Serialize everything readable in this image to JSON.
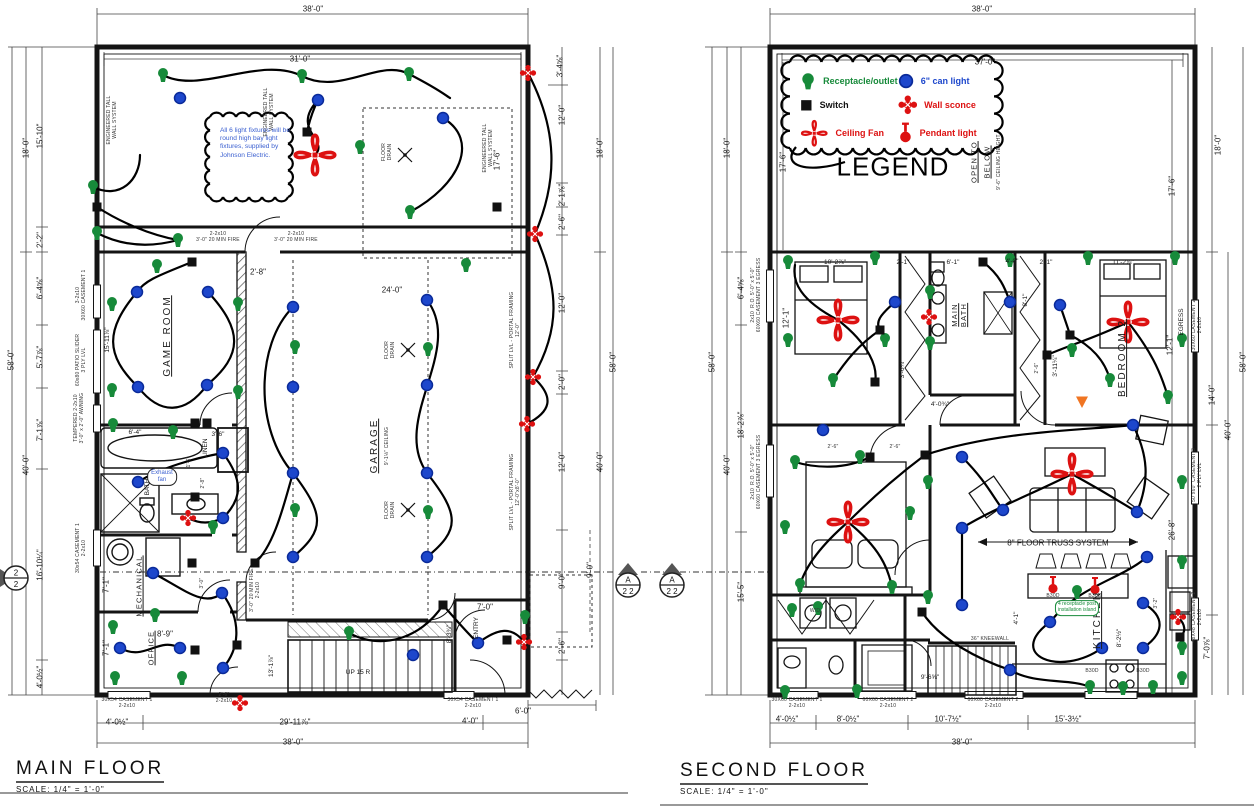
{
  "titles": {
    "main_floor": {
      "label": "MAIN FLOOR",
      "scale": "SCALE: 1/4\" = 1'-0\""
    },
    "second_floor": {
      "label": "SECOND FLOOR",
      "scale": "SCALE: 1/4\" = 1'-0\""
    }
  },
  "legend": {
    "title": "LEGEND",
    "items": [
      {
        "symbol": "r",
        "label": "Receptacle/outlet",
        "color": "#178a3a"
      },
      {
        "symbol": "c",
        "label": "6\" can light",
        "color": "#1d47cc"
      },
      {
        "symbol": "s",
        "label": "Switch",
        "color": "#111111"
      },
      {
        "symbol": "w",
        "label": "Wall sconce",
        "color": "#dd1111"
      },
      {
        "symbol": "f",
        "label": "Ceiling Fan",
        "color": "#dd1111"
      },
      {
        "symbol": "p",
        "label": "Pendant light",
        "color": "#dd1111"
      }
    ]
  },
  "notes": {
    "fixture_note": "All 6 light fixtures will be round high bay light fixtures, supplied by Johnson Electric."
  },
  "colors": {
    "receptacle": "#178a3a",
    "canlight": "#1d47cc",
    "switch": "#111111",
    "red_fixture": "#dd1111",
    "wire": "#000000",
    "wall": "#141414",
    "marker_orange": "#f07522"
  },
  "labels": [
    [
      "38'-0\"",
      313,
      9,
      "d",
      0
    ],
    [
      "31'-0\"",
      300,
      59,
      "d",
      0
    ],
    [
      "3'-4⅝\"",
      560,
      66,
      "d",
      -90
    ],
    [
      "17'-6\"",
      497,
      160,
      "d",
      -90
    ],
    [
      "18'-0\"",
      26,
      148,
      "d",
      -90
    ],
    [
      "15'-10\"",
      40,
      136,
      "d",
      -90
    ],
    [
      "2'-2\"",
      40,
      240,
      "d",
      -90
    ],
    [
      "6'-4⅝\"",
      40,
      288,
      "d",
      -90
    ],
    [
      "5'-7⅞\"",
      40,
      357,
      "d",
      -90
    ],
    [
      "7'-1⅞\"",
      40,
      430,
      "d",
      -90
    ],
    [
      "16'-10¼\"",
      40,
      565,
      "d",
      -90
    ],
    [
      "4'-0½\"",
      40,
      677,
      "d",
      -90
    ],
    [
      "58'-0\"",
      11,
      360,
      "d",
      -90
    ],
    [
      "40'-0\"",
      26,
      465,
      "d",
      -90
    ],
    [
      "3-2x10\n30X60 CASEMENT 1",
      82,
      295,
      "mic",
      -90
    ],
    [
      "60x80 PATIO SLIDER\n3 PLY LVL",
      82,
      360,
      "mic",
      -90
    ],
    [
      "TEMPERED 2-2x10\n3'-0\" x 2'-0\" AWNING",
      80,
      418,
      "mic",
      -90
    ],
    [
      "30x54 CASEMENT 1\n2-2x10",
      82,
      548,
      "mic",
      -90
    ],
    [
      "15'-11⅞\"",
      108,
      340,
      "tin",
      -90
    ],
    [
      "ENGINEERED TALL\nWALL SYSTEM",
      113,
      120,
      "mic",
      -90
    ],
    [
      "ENGINEERED TALL\nWALL SYSTEM",
      270,
      112,
      "mic",
      -90
    ],
    [
      "ENGINEERED TALL\nWALL SYSTEM",
      489,
      148,
      "mic",
      -90
    ],
    [
      "2-2x10\n3'-0\" 20 MIN FIRE",
      218,
      238,
      "mic",
      0
    ],
    [
      "2-2x10\n3'-0\" 20 MIN FIRE",
      296,
      238,
      "mic",
      0
    ],
    [
      "FLOOR\nDRAIN",
      388,
      152,
      "mic",
      -90
    ],
    [
      "FLOOR\nDRAIN",
      391,
      350,
      "mic",
      -90
    ],
    [
      "FLOOR\nDRAIN",
      391,
      510,
      "mic",
      -90
    ],
    [
      "GAME ROOM",
      168,
      336,
      "room",
      -90
    ],
    [
      "GARAGE",
      375,
      446,
      "room",
      -90
    ],
    [
      "9'-1⅛\" CEILING",
      388,
      446,
      "mic",
      -90
    ],
    [
      "24'-0\"",
      392,
      290,
      "d",
      0
    ],
    [
      "2'-8\"",
      258,
      272,
      "d",
      0
    ],
    [
      "SPLIT LVL - PORTAL FRAMING\n12'-0\"",
      516,
      330,
      "mic",
      -90
    ],
    [
      "SPLIT LVL - PORTAL FRAMING\n12'-0\"x8'-0\"",
      516,
      492,
      "mic",
      -90
    ],
    [
      "6'-4\"",
      135,
      433,
      "tin",
      0
    ],
    [
      "3'-6\"",
      218,
      435,
      "tin",
      0
    ],
    [
      "LINEN",
      206,
      448,
      "tin",
      -90
    ],
    [
      "1'-6\"",
      190,
      462,
      "mic",
      -90
    ],
    [
      "BATH",
      148,
      487,
      "tin",
      -90
    ],
    [
      "2'-8\"",
      204,
      483,
      "mic",
      -90
    ],
    [
      "MECHANICAL",
      140,
      586,
      "rooms",
      -90
    ],
    [
      "OFFICE",
      152,
      648,
      "rooms",
      -90
    ],
    [
      "8'-9\"",
      165,
      634,
      "d",
      0
    ],
    [
      "7'-1\"",
      106,
      585,
      "d",
      -90
    ],
    [
      "7'-1\"",
      106,
      648,
      "d",
      -90
    ],
    [
      "3'-0\"",
      203,
      583,
      "mic",
      -90
    ],
    [
      "3'-0\" 20 MIN FIRE\n2-2x10",
      256,
      590,
      "mic",
      -90
    ],
    [
      "13'-1⅞\"",
      272,
      666,
      "tin",
      -90
    ],
    [
      "UP 15 R",
      358,
      673,
      "tin",
      0
    ],
    [
      "ENTRY",
      477,
      628,
      "tin",
      -90
    ],
    [
      "7'-0\"",
      485,
      607,
      "d",
      0
    ],
    [
      "8'-3¾\"",
      450,
      634,
      "tin",
      -90
    ],
    [
      "30X54 CASEMENT 1\n2-2x10",
      127,
      704,
      "mic",
      0
    ],
    [
      "2'-6\"\n2-2x10",
      224,
      699,
      "mic",
      0
    ],
    [
      "30X54 CASEMENT 1\n2-2x10",
      473,
      704,
      "mic",
      0
    ],
    [
      "4'-0½\"",
      117,
      722,
      "d",
      0
    ],
    [
      "29'-11⅞\"",
      295,
      722,
      "d",
      0
    ],
    [
      "4'-0\"",
      470,
      721,
      "d",
      0
    ],
    [
      "6'-0\"",
      523,
      711,
      "d",
      0
    ],
    [
      "38'-0\"",
      293,
      742,
      "d",
      0
    ],
    [
      "12'-0\"",
      562,
      115,
      "d",
      -90
    ],
    [
      "18'-0\"",
      600,
      148,
      "d",
      -90
    ],
    [
      "2'-1⅞\"",
      562,
      195,
      "d",
      -90
    ],
    [
      "2'-6\"",
      562,
      222,
      "d",
      -90
    ],
    [
      "12'-0\"",
      562,
      303,
      "d",
      -90
    ],
    [
      "58'-0\"",
      613,
      362,
      "d",
      -90
    ],
    [
      "2'-0\"",
      562,
      382,
      "d",
      -90
    ],
    [
      "40'-0\"",
      600,
      462,
      "d",
      -90
    ],
    [
      "12'-0\"",
      562,
      462,
      "d",
      -90
    ],
    [
      "9'-0\"",
      562,
      581,
      "d",
      -90
    ],
    [
      "9'-0\"",
      590,
      570,
      "d",
      -90
    ],
    [
      "2'-6\"",
      562,
      646,
      "d",
      -90
    ],
    [
      "38'-0\"",
      982,
      9,
      "d",
      0
    ],
    [
      "37'-0\"",
      985,
      62,
      "d",
      0
    ],
    [
      "OPEN TO",
      975,
      162,
      "rooms",
      -90
    ],
    [
      "BELOW",
      988,
      162,
      "rooms",
      -90
    ],
    [
      "9'-6\" CEILING HEIGHT",
      1000,
      162,
      "mic",
      -90
    ],
    [
      "17'-6\"",
      783,
      162,
      "d",
      -90
    ],
    [
      "18'-0\"",
      727,
      148,
      "d",
      -90
    ],
    [
      "58'-0\"",
      712,
      362,
      "d",
      -90
    ],
    [
      "40'-0\"",
      727,
      465,
      "d",
      -90
    ],
    [
      "6'-4⅝\"",
      741,
      288,
      "d",
      -90
    ],
    [
      "18'-2⅞\"",
      741,
      425,
      "d",
      -90
    ],
    [
      "15'-5\"",
      741,
      592,
      "d",
      -90
    ],
    [
      "2x10  R.O. 5'-0\" x 5'-0\"\n60X60 CASEMENT 3 EGRESS",
      757,
      295,
      "mic",
      -90
    ],
    [
      "2x10  R.O. 5'-0\" x 5'-0\"\n60X60 CASEMENT 3 EGRESS",
      757,
      472,
      "mic",
      -90
    ],
    [
      "10'-2⅞\"",
      835,
      263,
      "tin",
      0
    ],
    [
      "12'-1\"",
      786,
      318,
      "d",
      -90
    ],
    [
      "2'-1\"",
      903,
      263,
      "tin",
      0
    ],
    [
      "6'-1\"",
      953,
      263,
      "tin",
      0
    ],
    [
      "4'-0\"",
      1012,
      262,
      "tin",
      0
    ],
    [
      "2'-1\"",
      1046,
      263,
      "tin",
      0
    ],
    [
      "11'-2⅞\"",
      1123,
      263,
      "tin",
      0
    ],
    [
      "MAIN\nBATH",
      960,
      315,
      "rooms",
      -90
    ],
    [
      "8'-1\"",
      1026,
      300,
      "tin",
      -90
    ],
    [
      "BEDROOM 2",
      1123,
      358,
      "room",
      -90
    ],
    [
      "12'-1\"",
      1170,
      345,
      "d",
      -90
    ],
    [
      "EGRESS",
      1182,
      322,
      "tin",
      -90
    ],
    [
      "30X60 CASEMENT 2\n2-2x10",
      1198,
      325,
      "mic",
      -90
    ],
    [
      "3'-11¼\"",
      1056,
      366,
      "tin",
      -90
    ],
    [
      "2'-6\"",
      1038,
      368,
      "mic",
      -90
    ],
    [
      "4'-0¾\"",
      940,
      405,
      "tin",
      0
    ],
    [
      "3'-6¼\"",
      903,
      369,
      "tin",
      -90
    ],
    [
      "2'-6\"",
      833,
      448,
      "mic",
      0
    ],
    [
      "2'-6\"",
      895,
      448,
      "mic",
      0
    ],
    [
      "8\" FLOOR TRUSS SYSTEM",
      1058,
      543,
      "d",
      0
    ],
    [
      "26'-8\"",
      1172,
      530,
      "d",
      -90
    ],
    [
      "50\"x60\" CASEMENT 3\n2 PLY LVL",
      1198,
      475,
      "mic",
      -90
    ],
    [
      "KITCHEN",
      1098,
      620,
      "room",
      -90
    ],
    [
      "8'-2½\"",
      1120,
      638,
      "tin",
      -90
    ],
    [
      "4'-1\"",
      1017,
      618,
      "tin",
      -90
    ],
    [
      "36\" KNEEWALL",
      990,
      640,
      "mic",
      0
    ],
    [
      "3'-2\"",
      1157,
      603,
      "mic",
      -90
    ],
    [
      "9'-6⅝\"",
      930,
      678,
      "tin",
      0
    ],
    [
      "48X48 CASEMENT 2\n2-2x10",
      1198,
      617,
      "mic",
      -90
    ],
    [
      "7'-0⅞\"",
      1207,
      648,
      "d",
      -90
    ],
    [
      "18'-0\"",
      1218,
      145,
      "d",
      -90
    ],
    [
      "17'-6\"",
      1172,
      186,
      "d",
      -90
    ],
    [
      "14'-0\"",
      1212,
      395,
      "d",
      -90
    ],
    [
      "40'-0\"",
      1228,
      430,
      "d",
      -90
    ],
    [
      "58'-0\"",
      1243,
      362,
      "d",
      -90
    ],
    [
      "30X60 CASEMENT 1\n2-2x10",
      797,
      704,
      "mic",
      0
    ],
    [
      "60X60 CASEMENT 2\n2-2x10",
      888,
      704,
      "mic",
      0
    ],
    [
      "60X60 CASEMENT 2\n2-2x10",
      993,
      704,
      "mic",
      0
    ],
    [
      "4'-0½\"",
      787,
      719,
      "d",
      0
    ],
    [
      "8'-0½\"",
      848,
      719,
      "d",
      0
    ],
    [
      "10'-7½\"",
      948,
      719,
      "d",
      0
    ],
    [
      "15'-3½\"",
      1068,
      719,
      "d",
      0
    ],
    [
      "38'-0\"",
      962,
      742,
      "d",
      0
    ],
    [
      "B30D",
      1053,
      597,
      "mic",
      0
    ],
    [
      "B30D",
      1095,
      597,
      "mic",
      0
    ],
    [
      "B30D",
      1092,
      672,
      "mic",
      0
    ],
    [
      "B30D",
      1143,
      672,
      "mic",
      0
    ],
    [
      "W/D",
      815,
      612,
      "mic",
      0
    ],
    [
      "Exhaust\nfan",
      162,
      477,
      "bnote",
      0
    ],
    [
      "4 receptacle post\ninstallation island",
      1077,
      608,
      "gnote",
      0
    ]
  ],
  "symbols": [
    [
      "r",
      163,
      75
    ],
    [
      "r",
      302,
      76
    ],
    [
      "r",
      409,
      74
    ],
    [
      "r",
      360,
      147
    ],
    [
      "r",
      93,
      187
    ],
    [
      "r",
      97,
      233
    ],
    [
      "r",
      410,
      212
    ],
    [
      "r",
      178,
      240
    ],
    [
      "r",
      157,
      266
    ],
    [
      "r",
      112,
      304
    ],
    [
      "r",
      238,
      304
    ],
    [
      "r",
      112,
      390
    ],
    [
      "r",
      238,
      392
    ],
    [
      "r",
      295,
      347
    ],
    [
      "r",
      295,
      510
    ],
    [
      "r",
      428,
      349
    ],
    [
      "r",
      428,
      512
    ],
    [
      "r",
      466,
      265
    ],
    [
      "r",
      113,
      425
    ],
    [
      "r",
      173,
      432
    ],
    [
      "r",
      213,
      527
    ],
    [
      "r",
      155,
      615
    ],
    [
      "r",
      113,
      627
    ],
    [
      "r",
      115,
      678
    ],
    [
      "r",
      182,
      678
    ],
    [
      "r",
      525,
      617
    ],
    [
      "r",
      349,
      633
    ],
    [
      "c",
      180,
      98
    ],
    [
      "c",
      318,
      100
    ],
    [
      "c",
      443,
      118
    ],
    [
      "c",
      137,
      292
    ],
    [
      "c",
      208,
      292
    ],
    [
      "c",
      138,
      387
    ],
    [
      "c",
      207,
      385
    ],
    [
      "c",
      293,
      307
    ],
    [
      "c",
      293,
      387
    ],
    [
      "c",
      293,
      473
    ],
    [
      "c",
      293,
      557
    ],
    [
      "c",
      427,
      300
    ],
    [
      "c",
      427,
      385
    ],
    [
      "c",
      427,
      473
    ],
    [
      "c",
      427,
      557
    ],
    [
      "c",
      138,
      482
    ],
    [
      "c",
      223,
      453
    ],
    [
      "c",
      223,
      518
    ],
    [
      "c",
      153,
      573
    ],
    [
      "c",
      120,
      648
    ],
    [
      "c",
      180,
      648
    ],
    [
      "c",
      222,
      593
    ],
    [
      "c",
      223,
      668
    ],
    [
      "c",
      478,
      643
    ],
    [
      "c",
      413,
      655
    ],
    [
      "s",
      97,
      207
    ],
    [
      "s",
      307,
      132
    ],
    [
      "s",
      497,
      207
    ],
    [
      "s",
      192,
      262
    ],
    [
      "s",
      195,
      423
    ],
    [
      "s",
      207,
      423
    ],
    [
      "s",
      195,
      497
    ],
    [
      "s",
      192,
      563
    ],
    [
      "s",
      255,
      563
    ],
    [
      "s",
      195,
      650
    ],
    [
      "s",
      237,
      645
    ],
    [
      "s",
      443,
      605
    ],
    [
      "s",
      507,
      640
    ],
    [
      "f",
      315,
      155
    ],
    [
      "w",
      528,
      73
    ],
    [
      "w",
      535,
      234
    ],
    [
      "w",
      533,
      377
    ],
    [
      "w",
      527,
      424
    ],
    [
      "w",
      188,
      518
    ],
    [
      "w",
      524,
      642
    ],
    [
      "w",
      240,
      703
    ],
    [
      "d",
      405,
      155
    ],
    [
      "d",
      408,
      350
    ],
    [
      "d",
      408,
      510
    ],
    [
      "r",
      788,
      262
    ],
    [
      "r",
      875,
      258
    ],
    [
      "r",
      1010,
      260
    ],
    [
      "r",
      1088,
      258
    ],
    [
      "r",
      1175,
      258
    ],
    [
      "r",
      788,
      340
    ],
    [
      "r",
      885,
      340
    ],
    [
      "r",
      930,
      292
    ],
    [
      "r",
      930,
      343
    ],
    [
      "r",
      833,
      380
    ],
    [
      "r",
      1072,
      350
    ],
    [
      "r",
      1110,
      380
    ],
    [
      "r",
      1168,
      397
    ],
    [
      "r",
      1182,
      340
    ],
    [
      "r",
      795,
      462
    ],
    [
      "r",
      860,
      457
    ],
    [
      "r",
      928,
      482
    ],
    [
      "r",
      910,
      513
    ],
    [
      "r",
      785,
      527
    ],
    [
      "r",
      800,
      585
    ],
    [
      "r",
      892,
      587
    ],
    [
      "r",
      928,
      597
    ],
    [
      "r",
      792,
      610
    ],
    [
      "r",
      818,
      608
    ],
    [
      "r",
      1182,
      482
    ],
    [
      "r",
      1182,
      562
    ],
    [
      "r",
      1077,
      592
    ],
    [
      "r",
      1182,
      648
    ],
    [
      "r",
      1182,
      678
    ],
    [
      "r",
      1090,
      687
    ],
    [
      "r",
      1123,
      688
    ],
    [
      "r",
      1153,
      687
    ],
    [
      "r",
      785,
      692
    ],
    [
      "r",
      857,
      691
    ],
    [
      "c",
      895,
      302
    ],
    [
      "c",
      1060,
      305
    ],
    [
      "c",
      1010,
      302
    ],
    [
      "c",
      823,
      430
    ],
    [
      "c",
      962,
      457
    ],
    [
      "c",
      1003,
      510
    ],
    [
      "c",
      962,
      528
    ],
    [
      "c",
      962,
      605
    ],
    [
      "c",
      1133,
      425
    ],
    [
      "c",
      1137,
      512
    ],
    [
      "c",
      1147,
      557
    ],
    [
      "c",
      1050,
      622
    ],
    [
      "c",
      1102,
      648
    ],
    [
      "c",
      1143,
      603
    ],
    [
      "c",
      1143,
      648
    ],
    [
      "c",
      1010,
      670
    ],
    [
      "s",
      880,
      330
    ],
    [
      "s",
      983,
      262
    ],
    [
      "s",
      875,
      382
    ],
    [
      "s",
      1070,
      335
    ],
    [
      "s",
      1047,
      355
    ],
    [
      "s",
      870,
      457
    ],
    [
      "s",
      925,
      455
    ],
    [
      "s",
      922,
      612
    ],
    [
      "s",
      1180,
      637
    ],
    [
      "f",
      838,
      320
    ],
    [
      "f",
      1128,
      322
    ],
    [
      "f",
      848,
      522
    ],
    [
      "f",
      1072,
      474
    ],
    [
      "w",
      929,
      317
    ],
    [
      "w",
      1178,
      617
    ],
    [
      "p",
      1053,
      585
    ],
    [
      "p",
      1095,
      586
    ],
    [
      "o",
      1082,
      402
    ]
  ],
  "markers": [
    {
      "x": 16,
      "y": 578,
      "top": "2",
      "bottom": "2",
      "dir": "right"
    },
    {
      "x": 628,
      "y": 585,
      "top": "A",
      "bottom": "2 2",
      "dir": "up"
    },
    {
      "x": 672,
      "y": 585,
      "top": "A",
      "bottom": "2 2",
      "dir": "up"
    }
  ]
}
